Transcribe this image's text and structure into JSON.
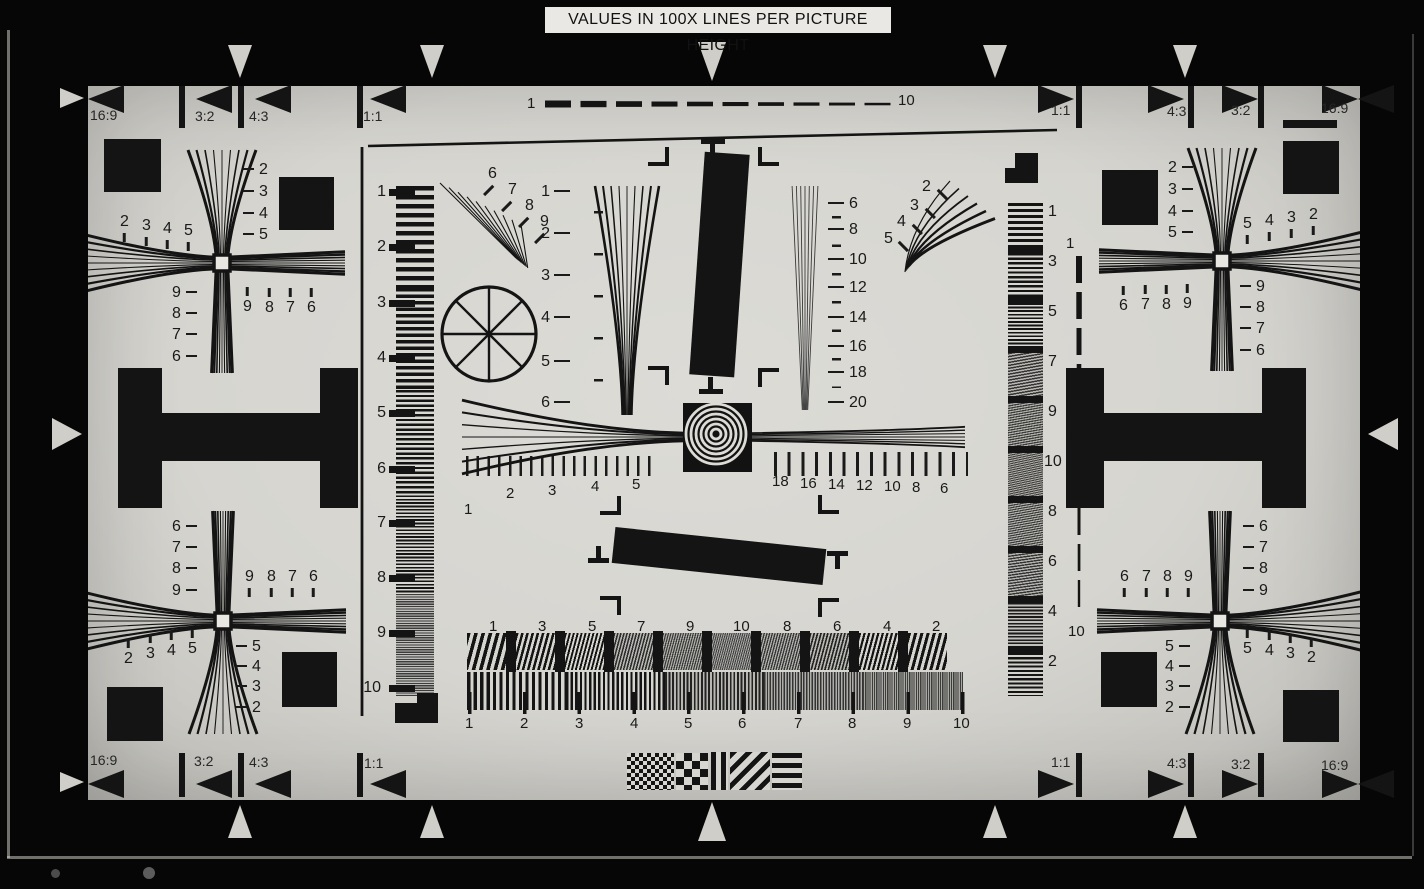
{
  "title": "VALUES IN 100X LINES PER PICTURE HEIGHT",
  "colors": {
    "ink": "#141414",
    "chart_bg": "#d6d5d0",
    "photo_bg": "#060606",
    "title_bg": "#e9e8e4"
  },
  "aspect": {
    "top_left": [
      "16:9",
      "3:2",
      "4:3",
      "1:1"
    ],
    "top_right": [
      "1:1",
      "4:3",
      "3:2",
      "16:9"
    ],
    "bottom_left": [
      "16:9",
      "3:2",
      "4:3",
      "1:1"
    ],
    "bottom_right": [
      "1:1",
      "4:3",
      "3:2",
      "16:9"
    ]
  },
  "dash_horizontal": {
    "start": "1",
    "end": "10"
  },
  "dash_vertical": {
    "start": "1",
    "end": "10"
  },
  "strip_left": [
    "1",
    "2",
    "3",
    "4",
    "5",
    "6",
    "7",
    "8",
    "9",
    "10"
  ],
  "strip_right": [
    "1",
    "3",
    "5",
    "7",
    "9",
    "10",
    "8",
    "6",
    "4",
    "2"
  ],
  "wedge_left": [
    "1",
    "2",
    "3",
    "4",
    "5",
    "6"
  ],
  "wedge_right": [
    "6",
    "8",
    "10",
    "12",
    "14",
    "16",
    "18",
    "20"
  ],
  "ruler_left": [
    "1",
    "2",
    "3",
    "4",
    "5"
  ],
  "ruler_right": [
    "18",
    "16",
    "14",
    "12",
    "10",
    "8",
    "6"
  ],
  "bars_top": [
    "1",
    "3",
    "5",
    "7",
    "9",
    "10",
    "8",
    "6",
    "4",
    "2"
  ],
  "bars_bottom": [
    "1",
    "2",
    "3",
    "4",
    "5",
    "6",
    "7",
    "8",
    "9",
    "10"
  ],
  "diag_left": [
    "6",
    "7",
    "8",
    "9"
  ],
  "diag_right": [
    "2",
    "3",
    "4",
    "5"
  ],
  "fans": {
    "tl": {
      "v_top": [
        "2",
        "3",
        "4",
        "5"
      ],
      "v_bot": [
        "9",
        "8",
        "7",
        "6"
      ],
      "h_top": [
        "2",
        "3",
        "4",
        "5"
      ],
      "h_bot": [
        "9",
        "8",
        "7",
        "6"
      ]
    },
    "tr": {
      "v_top": [
        "2",
        "3",
        "4",
        "5"
      ],
      "v_bot": [
        "9",
        "8",
        "7",
        "6"
      ],
      "h_top": [
        "5",
        "4",
        "3",
        "2"
      ],
      "h_bot": [
        "6",
        "7",
        "8",
        "9"
      ]
    },
    "bl": {
      "v_top": [
        "6",
        "7",
        "8",
        "9"
      ],
      "v_bot": [
        "5",
        "4",
        "3",
        "2"
      ],
      "h_top": [
        "9",
        "8",
        "7",
        "6"
      ],
      "h_bot": [
        "2",
        "3",
        "4",
        "5"
      ]
    },
    "br": {
      "v_top": [
        "6",
        "7",
        "8",
        "9"
      ],
      "v_bot": [
        "5",
        "4",
        "3",
        "2"
      ],
      "h_top": [
        "6",
        "7",
        "8",
        "9"
      ],
      "h_bot": [
        "5",
        "4",
        "3",
        "2"
      ]
    }
  }
}
